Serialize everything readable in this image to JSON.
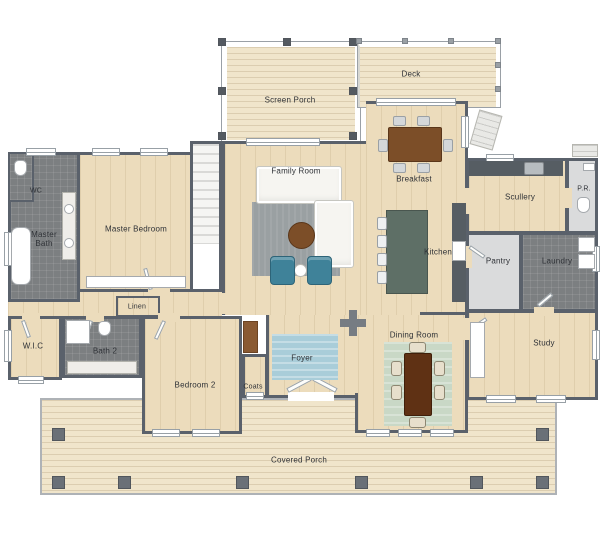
{
  "plan": {
    "type": "floor-plan",
    "labels": {
      "screen_porch": "Screen Porch",
      "deck": "Deck",
      "family_room": "Family Room",
      "breakfast": "Breakfast",
      "master_bedroom": "Master Bedroom",
      "master_bath": "Master Bath",
      "wc": "WC",
      "kitchen": "Kitchen",
      "scullery": "Scullery",
      "powder_room": "P.R.",
      "pantry": "Pantry",
      "laundry": "Laundry",
      "study": "Study",
      "dining_room": "Dining Room",
      "foyer": "Foyer",
      "coats": "Coats",
      "bedroom_2": "Bedroom 2",
      "bath_2": "Bath 2",
      "walk_in_closet": "W.I.C",
      "linen": "Linen",
      "covered_porch": "Covered Porch"
    },
    "colors": {
      "wall": "#5a616b",
      "wood": "#ecdcbc",
      "porch": "#f0e5cb",
      "tile-dark": "#7c7f81",
      "tile-light": "#dadbdc",
      "rug-gray": "#9aa0a2",
      "rug-blue": "#a9cdd9",
      "rug-green": "#c9d8c6",
      "island": "#5e6f66",
      "counter": "#565d63",
      "wood-furn": "#7c4e28",
      "wood-dining": "#5f3114",
      "teal": "#3f8299"
    }
  }
}
